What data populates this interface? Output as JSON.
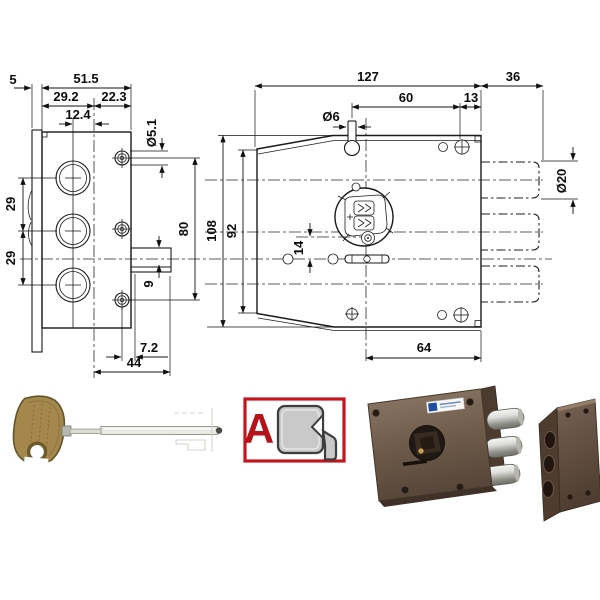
{
  "figure": {
    "type": "technical-drawing-lock",
    "background": "#ffffff",
    "line_color": "#1a1a1a"
  },
  "left_view": {
    "dims": {
      "plate_thickness": "5",
      "body_width": "51.5",
      "hole_col_offset": "29.2",
      "edge_offset": "22.3",
      "bolt_axis_offset": "12.4",
      "screw_hole_dia": "Ø5.1",
      "bolt_pitch_upper": "29",
      "bolt_pitch_lower": "29",
      "screw_span": "80",
      "flange_thickness": "9",
      "flange_offset": "7.2",
      "base_width": "44"
    }
  },
  "front_view": {
    "dims": {
      "case_width": "127",
      "bolt_throw": "36",
      "pin_span": "60",
      "edge_span": "13",
      "pin_dia": "Ø6",
      "bolt_dia": "Ø20",
      "total_height": "108",
      "side_height": "92",
      "cyl_offset": "14",
      "bottom_span": "64"
    }
  },
  "variant_badge": {
    "letter": "A",
    "border_color": "#c4161c",
    "letter_color": "#b5121b",
    "profile_fill": "#c9c9c9"
  },
  "photos": {
    "key_brass": "#a3874c",
    "shaft_steel": "#ececе6",
    "lock_body_brown": "#6d5a49",
    "bolt_chrome": "#d8d8d4",
    "knob_dark": "#1f1813",
    "strike_brown": "#5e4a39"
  }
}
